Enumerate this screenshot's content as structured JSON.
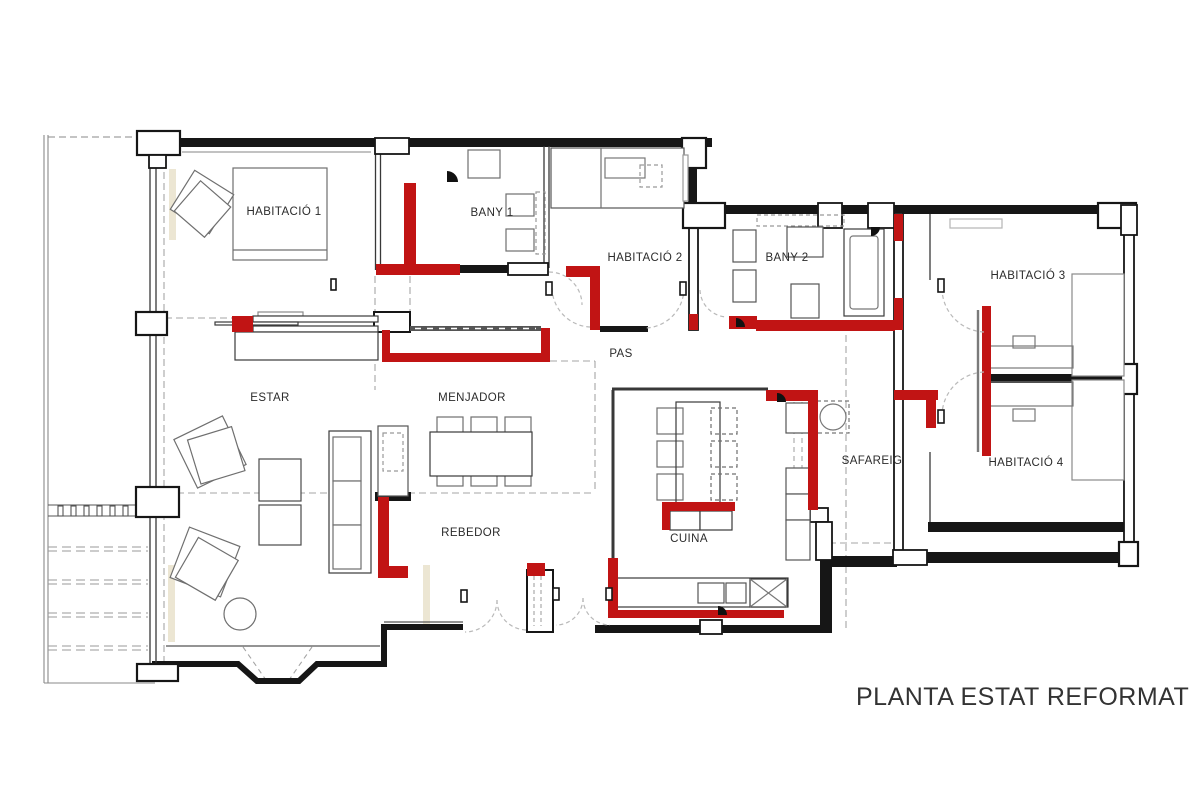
{
  "drawing": {
    "title": "PLANTA ESTAT REFORMAT",
    "rooms": {
      "habitacio1": "HABITACIÓ 1",
      "bany1": "BANY 1",
      "habitacio2": "HABITACIÓ 2",
      "bany2": "BANY 2",
      "habitacio3": "HABITACIÓ 3",
      "pas": "PAS",
      "estar": "ESTAR",
      "menjador": "MENJADOR",
      "safareig": "SAFAREIG",
      "habitacio4": "HABITACIÓ 4",
      "rebedor": "REBEDOR",
      "cuina": "CUINA"
    },
    "colors": {
      "new_construction": "#c11414",
      "existing_walls": "#161616"
    }
  }
}
